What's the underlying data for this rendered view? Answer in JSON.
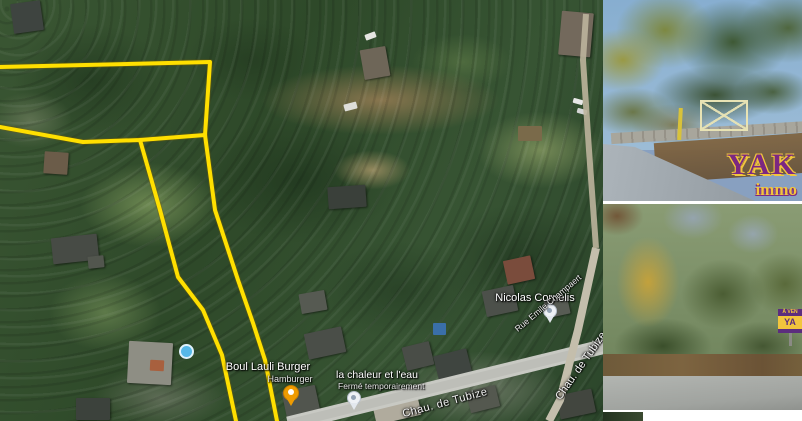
{
  "map": {
    "pois": {
      "burger": {
        "title": "Boul Lauli Burger",
        "subtitle": "Hamburger"
      },
      "chaleur": {
        "title": "la chaleur et l'eau",
        "status": "Fermé temporairement"
      },
      "cornelis": {
        "title": "Nicolas Cornelis"
      }
    },
    "streets": {
      "tubize_main": "Chau. de Tubize",
      "tubize_right": "Chau. de Tubize",
      "champaert": "Rue Emile Champaert"
    },
    "parcel_outline": {
      "color": "#ffdf00",
      "p1": "M0,67 L210,62 L205,135",
      "p2": "M0,127 L83,142 L140,140 L205,135",
      "p3": "M140,140 L160,210 L178,277 L203,310 L222,355 L236,421",
      "p4": "M205,135 L215,210 L238,280 L253,323 L265,360 L277,421"
    }
  },
  "branding": {
    "name": "YAK",
    "sub": "immo",
    "purple": "#7b2882",
    "yellow": "#f2c53d"
  },
  "sale_sign": {
    "line1": "À VEN",
    "line2": "YA"
  }
}
